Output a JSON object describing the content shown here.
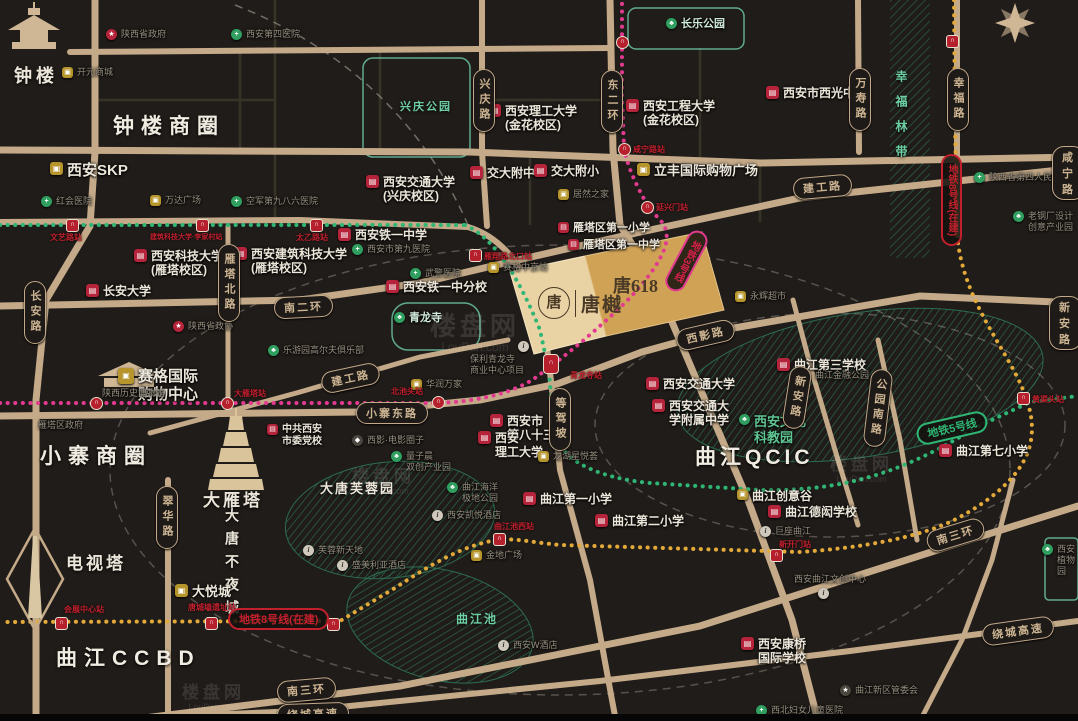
{
  "districts": [
    "钟楼商圈",
    "小寨商圈",
    "曲江CCBD",
    "曲江QCIC"
  ],
  "landmarks": [
    "钟楼",
    "大雁塔",
    "电视塔",
    "大唐不夜城",
    "大唐芙蓉园",
    "曲江池",
    "兴庆公园",
    "长乐公园",
    "青龙寺",
    "幸福林带"
  ],
  "schools": [
    "西安理工大学\n(金花校区)",
    "西安工程大学\n(金花校区)",
    "交大附中",
    "交大附小",
    "西安交通大学\n(兴庆校区)",
    "西安市西光中学",
    "西安铁一中学",
    "西安科技大学\n(雁塔校区)",
    "西安建筑科技大学\n(雁塔校区)",
    "长安大学",
    "西安铁一中分校",
    "雁塔区第一小学",
    "雁塔区第一中学",
    "西安市\n第八十三中",
    "西安\n理工大学",
    "西安交通大学",
    "西安交通大\n学附属中学",
    "曲江第三学校",
    "曲江第七小学",
    "曲江第一小学",
    "曲江第二小学",
    "曲江德闳学校",
    "西安康桥\n国际学校",
    "中共西安\n市委党校"
  ],
  "hospitals": [
    "西安第四医院",
    "红会医院",
    "空军第九八六医院",
    "西安市第九医院",
    "陕西省第四人民医院",
    "西北妇女儿童医院",
    "武警医院"
  ],
  "shopping": [
    "开元商城",
    "西安SKP",
    "万达广场",
    "立丰国际购物广场",
    "赛格国际\n购物中心",
    "大悦城",
    "居然之家",
    "华润万家",
    "金地广场",
    "永辉超市",
    "曲江创意谷",
    "龙湖星悦荟",
    "赛格中京坊"
  ],
  "places": [
    "西安凯悦酒店",
    "盛美利亚酒店",
    "西安W酒店",
    "芙蓉新天地",
    "巨座曲江",
    "西安曲江文创中心",
    "曲江新区管委会",
    "曲江海洋\n极地公园",
    "保利青龙寺\n商业中心项目",
    "西影·电影圈子",
    "量子晨\n双创产业园",
    "乐游园高尔夫俱乐部",
    "老钢厂设计\n创意产业园",
    "曲江金融公园",
    "西安文化\n科教园",
    "西安植物园",
    "陕西省政府",
    "陕西省政协",
    "雁塔区政府",
    "陕西历史博物馆"
  ],
  "roads": [
    "长安路",
    "雁塔北路",
    "翠华路",
    "兴庆路",
    "东二环",
    "万寿路",
    "幸福路",
    "南二环",
    "建工路",
    "建工路",
    "小寨东路",
    "西影路",
    "等驾坡",
    "新安路",
    "公园南路",
    "南三环",
    "南三环",
    "绕城高速",
    "绕城高速",
    "咸宁路",
    "新安路"
  ],
  "metro": {
    "line3": {
      "name": "地铁3号线",
      "color": "#e23a8e",
      "stations": [
        "大雁塔站",
        "北池头站",
        "青龙寺站",
        "延兴门站",
        "咸宁路站"
      ]
    },
    "line5": {
      "name": "地铁5号线",
      "color": "#2fb574",
      "stations": [
        "文艺路站",
        "建筑科技大学·李家村站",
        "太乙路站",
        "雁翔路北口站",
        "黄渠头站"
      ]
    },
    "line8": {
      "name": "地铁8号线(在建)",
      "color": "#e3aa3a",
      "stations": [
        "会展中心站",
        "唐城墙遗址站",
        "曲江池西站",
        "新开门站"
      ]
    }
  },
  "project": {
    "block1": "唐樾",
    "block1_seal": "唐",
    "block2": "唐618"
  },
  "watermark": {
    "text": "楼盘网",
    "sub": "LouPan.com"
  }
}
